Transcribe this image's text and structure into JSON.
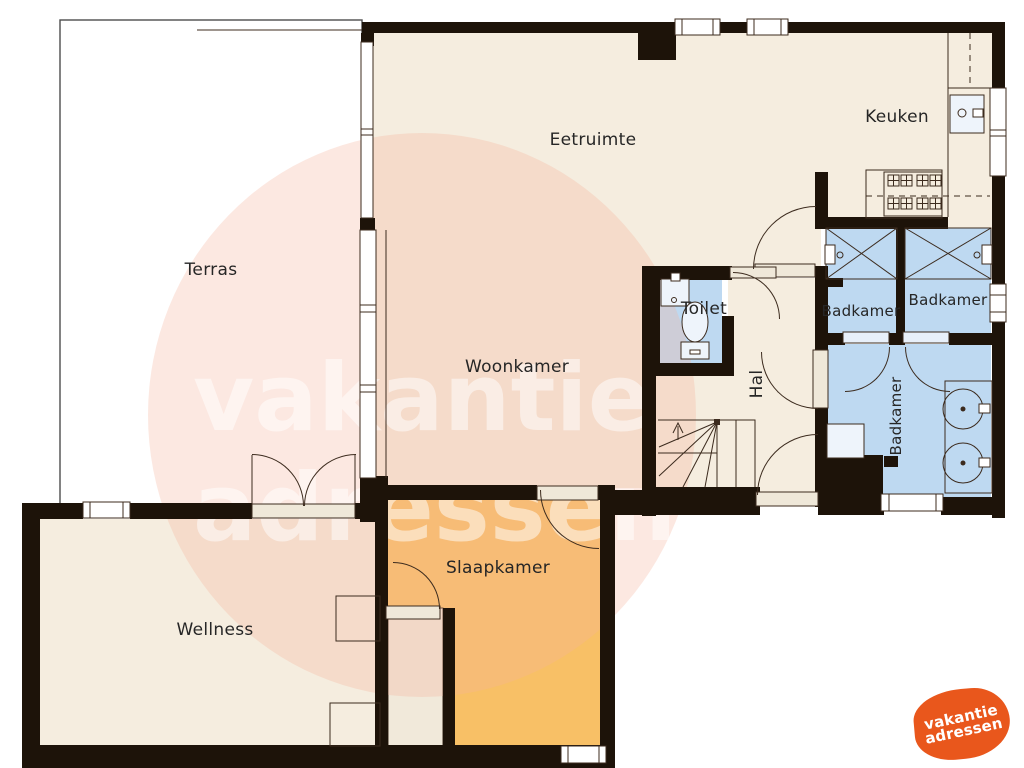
{
  "rooms": {
    "terras": "Terras",
    "eetruimte": "Eetruimte",
    "keuken": "Keuken",
    "woonkamer": "Woonkamer",
    "toilet": "Toilet",
    "hal": "Hal",
    "badkamer_top_left": "Badkamer",
    "badkamer_top_right": "Badkamer",
    "badkamer_lower": "Badkamer",
    "slaapkamer": "Slaapkamer",
    "wellness": "Wellness"
  },
  "watermark": {
    "line1": "vakantie",
    "line2": "adressen"
  },
  "logo": {
    "line1": "vakantie",
    "line2": "adressen"
  },
  "colors": {
    "wall": "#1d1309",
    "room_cream": "#f5eddf",
    "room_blue": "#bed9f1",
    "room_orange": "#f8c066",
    "closet_cream": "#f1e9da",
    "line": "#3c2b1e",
    "watermark_pink": "#f5b49b",
    "logo_orange": "#e9571c"
  }
}
